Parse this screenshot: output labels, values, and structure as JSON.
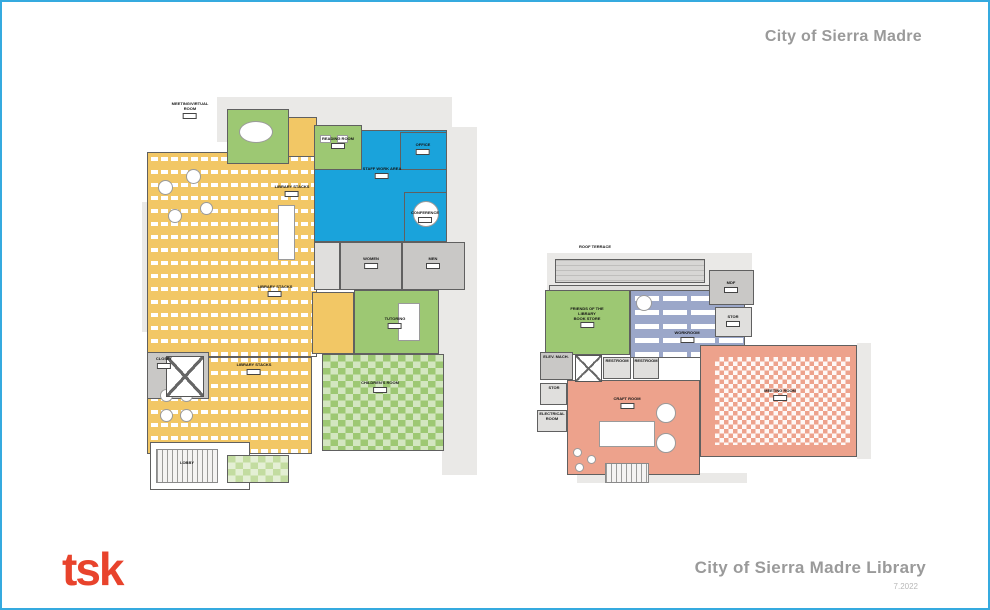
{
  "header": {
    "client_title": "City of Sierra Madre"
  },
  "footer": {
    "logo_text": "tsk",
    "logo_color": "#E8432C",
    "project_title": "City of Sierra Madre Library",
    "date_note": "7.2022"
  },
  "palette": {
    "border": "#35AADF",
    "title_gray": "#9A9A9A",
    "wall": "#606060",
    "yellow": "#F2C765",
    "green": "#9DC873",
    "green_light": "#C3DCA0",
    "blue": "#1AA3DB",
    "slate": "#9BA7C9",
    "salmon": "#EDA28C",
    "gray": "#C9C8C6",
    "gray_light": "#E0DFDD",
    "roof": "#D7D6D4"
  },
  "plans": [
    {
      "id": "level-1",
      "x": 140,
      "y": 95,
      "w": 335,
      "h": 395,
      "silhouettes": [
        [
          75,
          0,
          235,
          45
        ],
        [
          0,
          105,
          18,
          130
        ],
        [
          292,
          30,
          43,
          230
        ],
        [
          300,
          260,
          35,
          118
        ]
      ],
      "rooms": [
        {
          "id": "stacks-upper",
          "x": 5,
          "y": 55,
          "w": 170,
          "h": 205,
          "fill": "yellow",
          "pattern": "stacks"
        },
        {
          "id": "stacks-lower",
          "x": 5,
          "y": 260,
          "w": 165,
          "h": 97,
          "fill": "yellow",
          "pattern": "stacks"
        },
        {
          "id": "entry-corridor",
          "x": 115,
          "y": 20,
          "w": 60,
          "h": 40,
          "fill": "yellow"
        },
        {
          "id": "mid-yellow",
          "x": 170,
          "y": 195,
          "w": 42,
          "h": 62,
          "fill": "yellow"
        },
        {
          "id": "staff-work-area",
          "x": 172,
          "y": 33,
          "w": 133,
          "h": 112,
          "fill": "blue"
        },
        {
          "id": "reading-room",
          "x": 172,
          "y": 28,
          "w": 48,
          "h": 45,
          "fill": "green"
        },
        {
          "id": "office",
          "x": 258,
          "y": 35,
          "w": 47,
          "h": 38,
          "fill": "blue"
        },
        {
          "id": "conference",
          "x": 262,
          "y": 95,
          "w": 43,
          "h": 50,
          "fill": "blue"
        },
        {
          "id": "meeting-virtual-room",
          "x": 85,
          "y": 12,
          "w": 62,
          "h": 55,
          "fill": "green"
        },
        {
          "id": "utility",
          "x": 172,
          "y": 145,
          "w": 26,
          "h": 48,
          "fill": "gray_light"
        },
        {
          "id": "restroom-women",
          "x": 198,
          "y": 145,
          "w": 62,
          "h": 48,
          "fill": "gray"
        },
        {
          "id": "restroom-men",
          "x": 260,
          "y": 145,
          "w": 63,
          "h": 48,
          "fill": "gray"
        },
        {
          "id": "tutoring",
          "x": 212,
          "y": 193,
          "w": 85,
          "h": 64,
          "fill": "green"
        },
        {
          "id": "childrens-room",
          "x": 180,
          "y": 257,
          "w": 122,
          "h": 97,
          "fill": "green",
          "pattern": "scatter"
        },
        {
          "id": "closet",
          "x": 5,
          "y": 255,
          "w": 62,
          "h": 47,
          "fill": "gray"
        },
        {
          "id": "lobby",
          "x": 8,
          "y": 345,
          "w": 100,
          "h": 48,
          "fill": "white"
        },
        {
          "id": "patio",
          "x": 85,
          "y": 358,
          "w": 62,
          "h": 28,
          "fill": "green_light",
          "pattern": "scatter"
        }
      ],
      "furniture": [
        {
          "shape": "ellipse",
          "x": 97,
          "y": 24,
          "w": 34,
          "h": 22
        },
        {
          "shape": "ellipse",
          "x": 16,
          "y": 83,
          "w": 15,
          "h": 15
        },
        {
          "shape": "ellipse",
          "x": 44,
          "y": 72,
          "w": 15,
          "h": 15
        },
        {
          "shape": "ellipse",
          "x": 26,
          "y": 112,
          "w": 14,
          "h": 14
        },
        {
          "shape": "ellipse",
          "x": 58,
          "y": 105,
          "w": 13,
          "h": 13
        },
        {
          "shape": "rect",
          "x": 136,
          "y": 108,
          "w": 17,
          "h": 55
        },
        {
          "shape": "ellipse",
          "x": 271,
          "y": 104,
          "w": 26,
          "h": 26
        },
        {
          "shape": "rect",
          "x": 256,
          "y": 206,
          "w": 22,
          "h": 38
        },
        {
          "shape": "ellipse",
          "x": 18,
          "y": 292,
          "w": 13,
          "h": 13
        },
        {
          "shape": "ellipse",
          "x": 38,
          "y": 292,
          "w": 13,
          "h": 13
        },
        {
          "shape": "ellipse",
          "x": 18,
          "y": 312,
          "w": 13,
          "h": 13
        },
        {
          "shape": "ellipse",
          "x": 38,
          "y": 312,
          "w": 13,
          "h": 13
        },
        {
          "shape": "xbox",
          "x": 24,
          "y": 259,
          "w": 38,
          "h": 41
        },
        {
          "shape": "stairs",
          "x": 14,
          "y": 352,
          "w": 62,
          "h": 34
        },
        {
          "shape": "rect",
          "x": 178,
          "y": 38,
          "w": 11,
          "h": 8
        },
        {
          "shape": "rect",
          "x": 195,
          "y": 38,
          "w": 11,
          "h": 8
        }
      ],
      "labels": [
        {
          "x": 48,
          "y": 5,
          "text": [
            "MEETING/VIRTUAL",
            "ROOM"
          ],
          "chip": true
        },
        {
          "x": 196,
          "y": 40,
          "text": [
            "READING ROOM"
          ],
          "chip": true
        },
        {
          "x": 240,
          "y": 70,
          "text": [
            "STAFF WORK AREA"
          ],
          "chip": true
        },
        {
          "x": 281,
          "y": 46,
          "text": [
            "OFFICE"
          ],
          "chip": true
        },
        {
          "x": 283,
          "y": 114,
          "text": [
            "CONFERENCE"
          ],
          "chip": true
        },
        {
          "x": 229,
          "y": 160,
          "text": [
            "WOMEN"
          ],
          "chip": true
        },
        {
          "x": 291,
          "y": 160,
          "text": [
            "MEN"
          ],
          "chip": true
        },
        {
          "x": 150,
          "y": 88,
          "text": [
            "LIBRARY STACKS"
          ],
          "chip": true
        },
        {
          "x": 133,
          "y": 188,
          "text": [
            "LIBRARY STACKS"
          ],
          "chip": true
        },
        {
          "x": 112,
          "y": 266,
          "text": [
            "LIBRARY STACKS"
          ],
          "chip": true
        },
        {
          "x": 253,
          "y": 220,
          "text": [
            "TUTORING"
          ],
          "chip": true
        },
        {
          "x": 238,
          "y": 284,
          "text": [
            "CHILDREN'S ROOM"
          ],
          "chip": true
        },
        {
          "x": 22,
          "y": 260,
          "text": [
            "CLOSET"
          ],
          "chip": true
        },
        {
          "x": 45,
          "y": 364,
          "text": [
            "LOBBY"
          ],
          "chip": false
        }
      ]
    },
    {
      "id": "level-2",
      "x": 535,
      "y": 243,
      "w": 385,
      "h": 240,
      "silhouettes": [
        [
          10,
          8,
          205,
          40
        ],
        [
          320,
          98,
          14,
          116
        ],
        [
          40,
          228,
          170,
          10
        ]
      ],
      "rooms": [
        {
          "id": "roof-terrace",
          "x": 18,
          "y": 14,
          "w": 150,
          "h": 24,
          "fill": "roof",
          "pattern": "roofhatch"
        },
        {
          "id": "roof-ledge",
          "x": 12,
          "y": 40,
          "w": 165,
          "h": 6,
          "fill": "gray_light"
        },
        {
          "id": "bookstore",
          "x": 8,
          "y": 45,
          "w": 85,
          "h": 65,
          "fill": "green"
        },
        {
          "id": "workroom",
          "x": 93,
          "y": 45,
          "w": 115,
          "h": 68,
          "fill": "slate",
          "pattern": "shelves"
        },
        {
          "id": "mdf",
          "x": 172,
          "y": 25,
          "w": 45,
          "h": 35,
          "fill": "gray"
        },
        {
          "id": "stor-a",
          "x": 178,
          "y": 62,
          "w": 37,
          "h": 30,
          "fill": "gray_light"
        },
        {
          "id": "meeting-room",
          "x": 163,
          "y": 100,
          "w": 157,
          "h": 112,
          "fill": "salmon"
        },
        {
          "id": "meeting-chairs",
          "x": 178,
          "y": 112,
          "w": 135,
          "h": 88,
          "fill": "salmon",
          "pattern": "chairs",
          "noborder": true
        },
        {
          "id": "craft-room",
          "x": 30,
          "y": 135,
          "w": 133,
          "h": 95,
          "fill": "salmon"
        },
        {
          "id": "elev-machine",
          "x": 3,
          "y": 107,
          "w": 33,
          "h": 28,
          "fill": "gray"
        },
        {
          "id": "restroom-1",
          "x": 66,
          "y": 112,
          "w": 28,
          "h": 22,
          "fill": "gray_light"
        },
        {
          "id": "restroom-2",
          "x": 96,
          "y": 112,
          "w": 26,
          "h": 22,
          "fill": "gray_light"
        },
        {
          "id": "stor-b",
          "x": 3,
          "y": 138,
          "w": 27,
          "h": 22,
          "fill": "gray_light"
        },
        {
          "id": "electrical-room",
          "x": 0,
          "y": 165,
          "w": 30,
          "h": 22,
          "fill": "gray_light"
        }
      ],
      "furniture": [
        {
          "shape": "xbox",
          "x": 38,
          "y": 110,
          "w": 27,
          "h": 27
        },
        {
          "shape": "rect",
          "x": 62,
          "y": 176,
          "w": 56,
          "h": 26
        },
        {
          "shape": "ellipse",
          "x": 119,
          "y": 158,
          "w": 20,
          "h": 20
        },
        {
          "shape": "ellipse",
          "x": 119,
          "y": 188,
          "w": 20,
          "h": 20
        },
        {
          "shape": "ellipse",
          "x": 99,
          "y": 50,
          "w": 16,
          "h": 16
        },
        {
          "shape": "ellipse",
          "x": 36,
          "y": 203,
          "w": 9,
          "h": 9
        },
        {
          "shape": "ellipse",
          "x": 50,
          "y": 210,
          "w": 9,
          "h": 9
        },
        {
          "shape": "ellipse",
          "x": 38,
          "y": 218,
          "w": 9,
          "h": 9
        },
        {
          "shape": "stairs",
          "x": 68,
          "y": 218,
          "w": 44,
          "h": 20
        }
      ],
      "labels": [
        {
          "x": 58,
          "y": 0,
          "text": [
            "ROOF TERRACE"
          ],
          "chip": false
        },
        {
          "x": 50,
          "y": 62,
          "text": [
            "FRIENDS OF THE",
            "LIBRARY",
            "BOOK STORE"
          ],
          "chip": true
        },
        {
          "x": 150,
          "y": 86,
          "text": [
            "WORKROOM"
          ],
          "chip": true
        },
        {
          "x": 194,
          "y": 36,
          "text": [
            "MDF"
          ],
          "chip": true
        },
        {
          "x": 196,
          "y": 70,
          "text": [
            "STOR"
          ],
          "chip": true
        },
        {
          "x": 243,
          "y": 144,
          "text": [
            "MEETING ROOM"
          ],
          "chip": true
        },
        {
          "x": 90,
          "y": 152,
          "text": [
            "CRAFT ROOM"
          ],
          "chip": true
        },
        {
          "x": 80,
          "y": 114,
          "text": [
            "RESTROOM"
          ],
          "chip": false
        },
        {
          "x": 109,
          "y": 114,
          "text": [
            "RESTROOM"
          ],
          "chip": false
        },
        {
          "x": 19,
          "y": 110,
          "text": [
            "ELEV. MACH."
          ],
          "chip": false
        },
        {
          "x": 17,
          "y": 141,
          "text": [
            "STOR"
          ],
          "chip": false
        },
        {
          "x": 15,
          "y": 167,
          "text": [
            "ELECTRICAL",
            "ROOM"
          ],
          "chip": false
        }
      ]
    }
  ]
}
